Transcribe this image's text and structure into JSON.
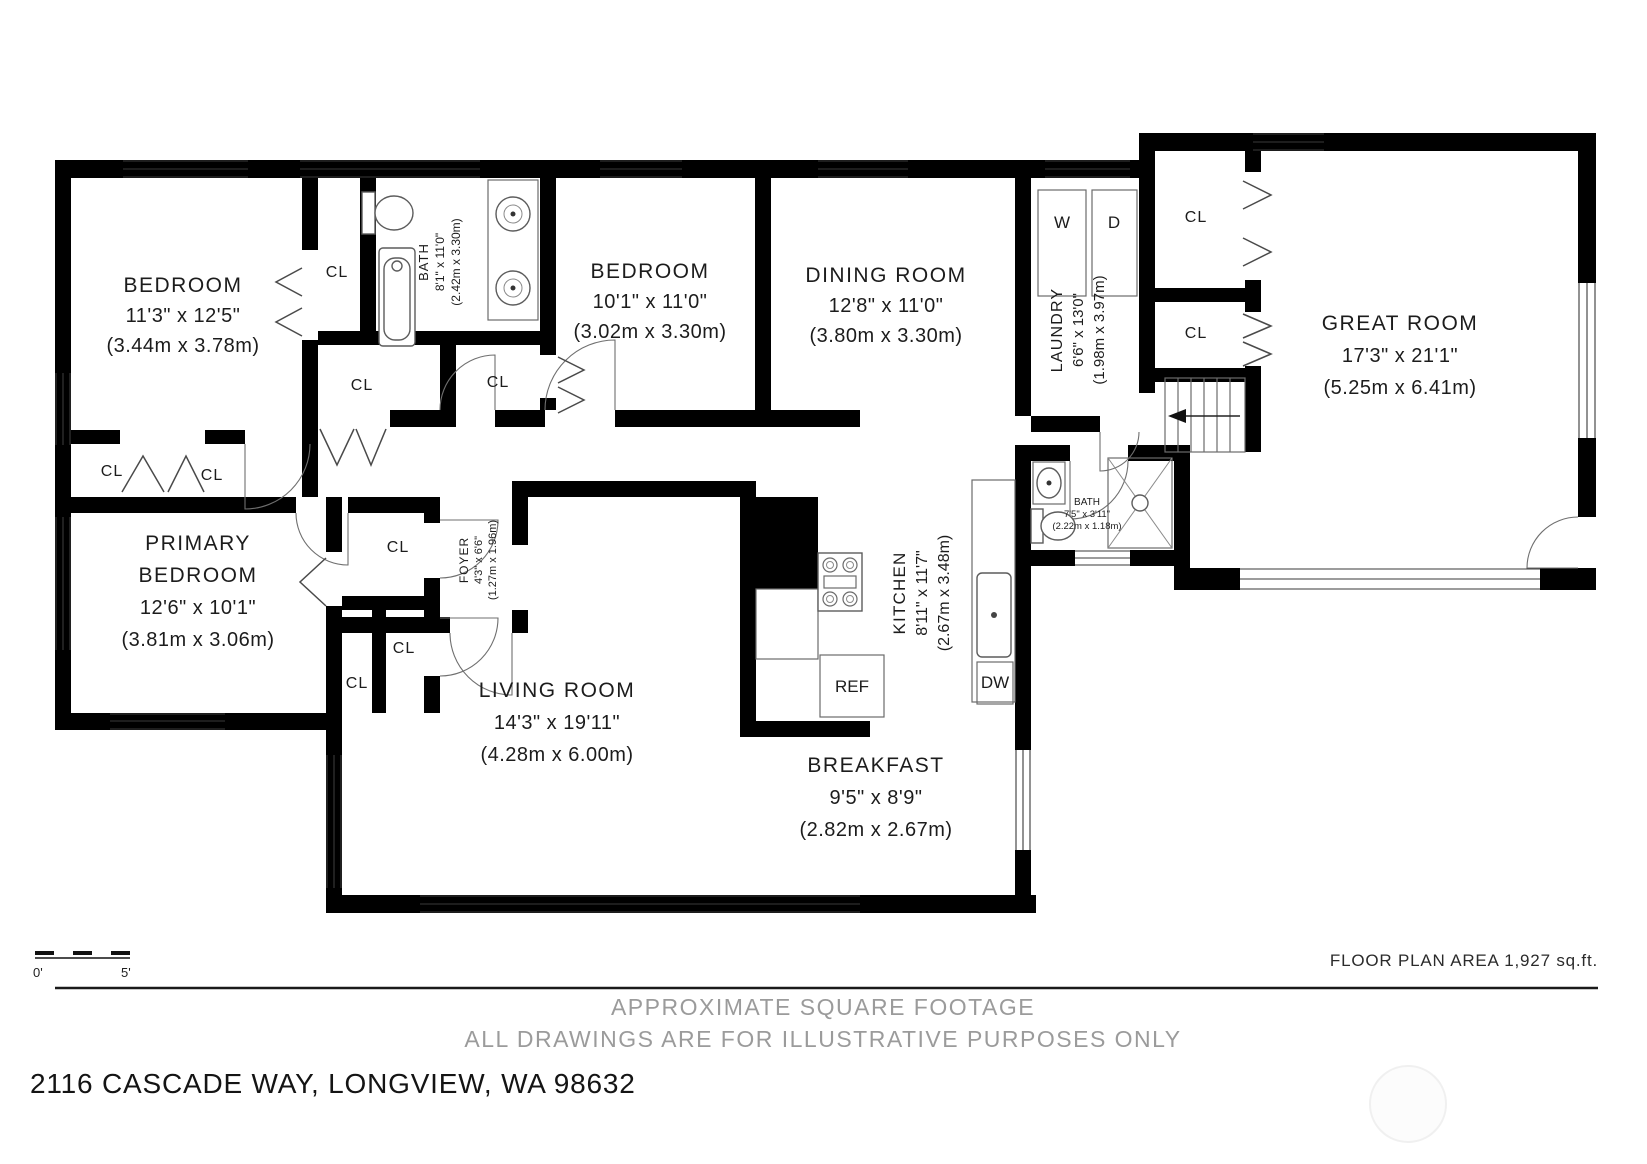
{
  "plan": {
    "rooms": [
      {
        "id": "bedroom-1",
        "name": "BEDROOM",
        "dims_ft": "11'3\" x 12'5\"",
        "dims_m": "(3.44m x 3.78m)"
      },
      {
        "id": "bedroom-2",
        "name": "BEDROOM",
        "dims_ft": "10'1\" x 11'0\"",
        "dims_m": "(3.02m x 3.30m)"
      },
      {
        "id": "dining-room",
        "name": "DINING ROOM",
        "dims_ft": "12'8\" x 11'0\"",
        "dims_m": "(3.80m x 3.30m)"
      },
      {
        "id": "great-room",
        "name": "GREAT ROOM",
        "dims_ft": "17'3\" x 21'1\"",
        "dims_m": "(5.25m x 6.41m)"
      },
      {
        "id": "primary-bedroom",
        "name_line1": "PRIMARY",
        "name_line2": "BEDROOM",
        "dims_ft": "12'6\" x 10'1\"",
        "dims_m": "(3.81m x 3.06m)"
      },
      {
        "id": "living-room",
        "name": "LIVING ROOM",
        "dims_ft": "14'3\" x 19'11\"",
        "dims_m": "(4.28m x 6.00m)"
      },
      {
        "id": "breakfast",
        "name": "BREAKFAST",
        "dims_ft": "9'5\" x 8'9\"",
        "dims_m": "(2.82m x 2.67m)"
      },
      {
        "id": "kitchen",
        "name": "KITCHEN",
        "dims_ft": "8'11\" x 11'7\"",
        "dims_m": "(2.67m x 3.48m)"
      },
      {
        "id": "laundry",
        "name": "LAUNDRY",
        "dims_ft": "6'6\" x 13'0\"",
        "dims_m": "(1.98m x 3.97m)"
      },
      {
        "id": "bath",
        "name": "BATH",
        "dims_ft": "8'1\" x 11'0\"",
        "dims_m": "(2.42m x 3.30m)"
      },
      {
        "id": "foyer",
        "name": "FOYER",
        "dims_ft": "4'3\" x 6'6\"",
        "dims_m": "(1.27m x 1.96m)"
      },
      {
        "id": "bath-2",
        "name": "BATH",
        "dims_ft": "7'5\" x 3'11\"",
        "dims_m": "(2.22m x 1.18m)"
      }
    ],
    "labels": {
      "closet": "CL",
      "washer": "W",
      "dryer": "D",
      "refrigerator": "REF",
      "dishwasher": "DW"
    }
  },
  "scale_bar": {
    "zero": "0'",
    "five": "5'"
  },
  "footer": {
    "area_note": "FLOOR PLAN AREA 1,927 sq.ft.",
    "disclaimer_line1": "APPROXIMATE SQUARE FOOTAGE",
    "disclaimer_line2": "ALL DRAWINGS ARE FOR ILLUSTRATIVE PURPOSES ONLY",
    "address": "2116 CASCADE WAY, LONGVIEW, WA 98632"
  },
  "colors": {
    "wall": "#000000",
    "text": "#1c1c1c",
    "muted_text": "#9b9b9b",
    "background": "#ffffff"
  }
}
